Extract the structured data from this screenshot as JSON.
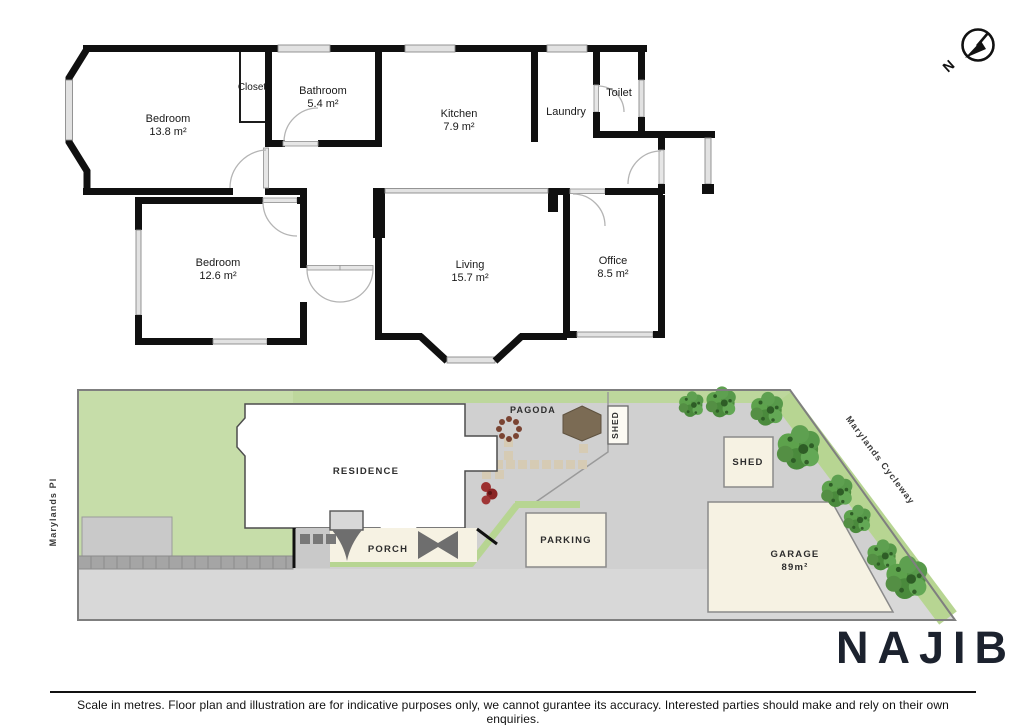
{
  "compass": {
    "north": "N"
  },
  "floorplan": {
    "rooms": {
      "bedroom1": {
        "name": "Bedroom",
        "area": "13.8 m²"
      },
      "closet": {
        "name": "Closet"
      },
      "bathroom": {
        "name": "Bathroom",
        "area": "5.4 m²"
      },
      "kitchen": {
        "name": "Kitchen",
        "area": "7.9 m²"
      },
      "laundry": {
        "name": "Laundry"
      },
      "toilet": {
        "name": "Toilet"
      },
      "bedroom2": {
        "name": "Bedroom",
        "area": "12.6 m²"
      },
      "living": {
        "name": "Living",
        "area": "15.7 m²"
      },
      "office": {
        "name": "Office",
        "area": "8.5 m²"
      }
    }
  },
  "siteplan": {
    "residence": "RESIDENCE",
    "porch": "PORCH",
    "pagoda": "PAGODA",
    "shed_small": "SHED",
    "shed_large": "SHED",
    "parking": "PARKING",
    "garage": "GARAGE",
    "garage_area": "89m²",
    "street_left": "Marylands Pl",
    "street_right": "Marylands Cycleway"
  },
  "branding": {
    "logo": "NAJIB"
  },
  "footer": {
    "disclaimer": "Scale in metres. Floor plan and illustration are for indicative purposes only, we cannot gurantee its accuracy. Interested parties should make and rely on their own enquiries."
  },
  "colors": {
    "wall": "#101010",
    "lawn": "#c6dda9",
    "ground": "#d0d0d0",
    "accent_green": "#b7d592",
    "cream": "#f6f2e3",
    "pagoda": "#7b6b54",
    "tree": "#4e8f3f",
    "logo": "#1c222e"
  }
}
